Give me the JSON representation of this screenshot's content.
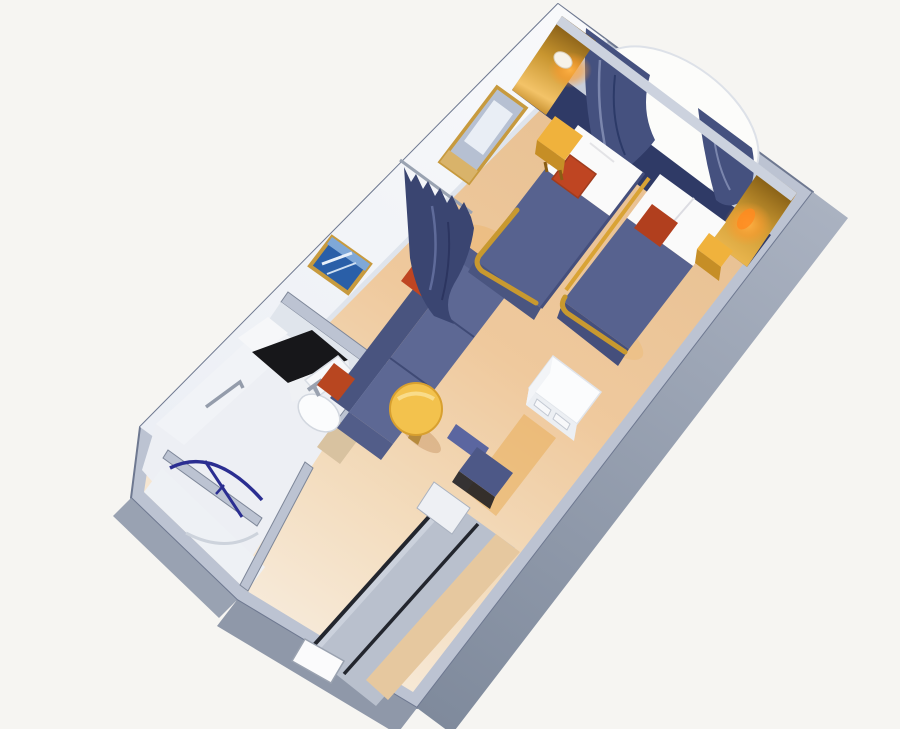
{
  "meta": {
    "title": "3D cutaway rendering of a cruise-ship oceanview stateroom floor plan",
    "width": 900,
    "height": 729
  },
  "colors": {
    "background": "#f6f5f2",
    "wall_top": "#bcc3d2",
    "wall_edge": "#6e7890",
    "wall_face_right": "#9aa3b4",
    "wall_face_bottom": "#8f98a9",
    "wall_face_bath": "#99a2b2",
    "interior_wall_white": "#f1f3f7",
    "interior_wall_white2": "#eef1f5",
    "partition_face": "#e0e5ec",
    "bathroom_floor": "#edeff4",
    "window_wall_gray": "#c7cdda",
    "window_white": "#fcfcfa",
    "headboard_navy": "#2f3a66",
    "curtain_navy": "#45517f",
    "divider_curtain_navy": "#3a4571",
    "valance_gray": "#ccd2de",
    "gold_bright": "#f0b23c",
    "gold_side": "#c68e26",
    "gold_trim": "#c8992f",
    "sconce_glow": "#ff9b2e",
    "bed_navy": "#57628f",
    "bed_navy_dark": "#454f7c",
    "pillow_white": "#fafafa",
    "cushion_red": "#bf4522",
    "cushion_red_dark": "#a03c1e",
    "sofa_navy": "#5d6894",
    "sofa_navy_dark": "#49547f",
    "sofa_arm": "#525d89",
    "table_yellow": "#f3c24d",
    "chair_back": "#5b66a0",
    "chair_navy": "#4d5887",
    "chair_shadow": "#14151c",
    "counter_black": "#17171a",
    "fixture_white": "#f7f8fa",
    "shower_arc_blue": "#2b2e91",
    "closet_gray": "#b9c0cd",
    "closet_strip_tan": "#e6c89f",
    "rail_dark": "#23262e",
    "picture_art_blue": "#2a5fa8",
    "mirror_glass": "#b6c0d2",
    "door_white": "#fbfbfc",
    "warm_strip": "#e8aa50",
    "desk_white": "#fbfcfd",
    "desk_front": "#eceff3"
  },
  "scene": {
    "objects": [
      "porthole-window",
      "window-curtains",
      "window-valance",
      "wall-sconces",
      "twin-bed-left",
      "twin-bed-right",
      "pillows",
      "red-throw-cushions",
      "nightstands",
      "headboard-panel",
      "privacy-curtain",
      "wall-mirror",
      "wall-picture",
      "sofa",
      "coffee-table",
      "desk",
      "desk-chair",
      "bathroom",
      "vanity-counter",
      "toilet",
      "towel-bar",
      "shower",
      "shower-curtain-rail",
      "wardrobe-sliding-doors",
      "corridor",
      "entry-door"
    ]
  }
}
